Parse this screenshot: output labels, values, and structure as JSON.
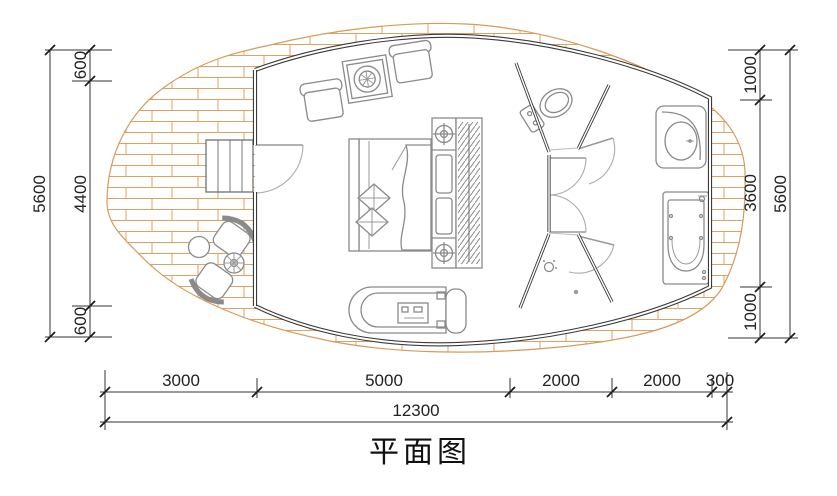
{
  "title": "平面图",
  "dimensions": {
    "left": {
      "total": "5600",
      "segments": [
        "600",
        "4400",
        "600"
      ]
    },
    "right": {
      "total": "5600",
      "segments": [
        "1000",
        "3600",
        "1000"
      ]
    },
    "bottom": {
      "total": "12300",
      "segments": [
        "3000",
        "5000",
        "2000",
        "2000",
        "300"
      ]
    }
  },
  "colors": {
    "deck_hatch": "#dfa263",
    "wall": "#3a3a3a",
    "furniture_line": "#8a8a8a",
    "dimension_line": "#333333"
  }
}
